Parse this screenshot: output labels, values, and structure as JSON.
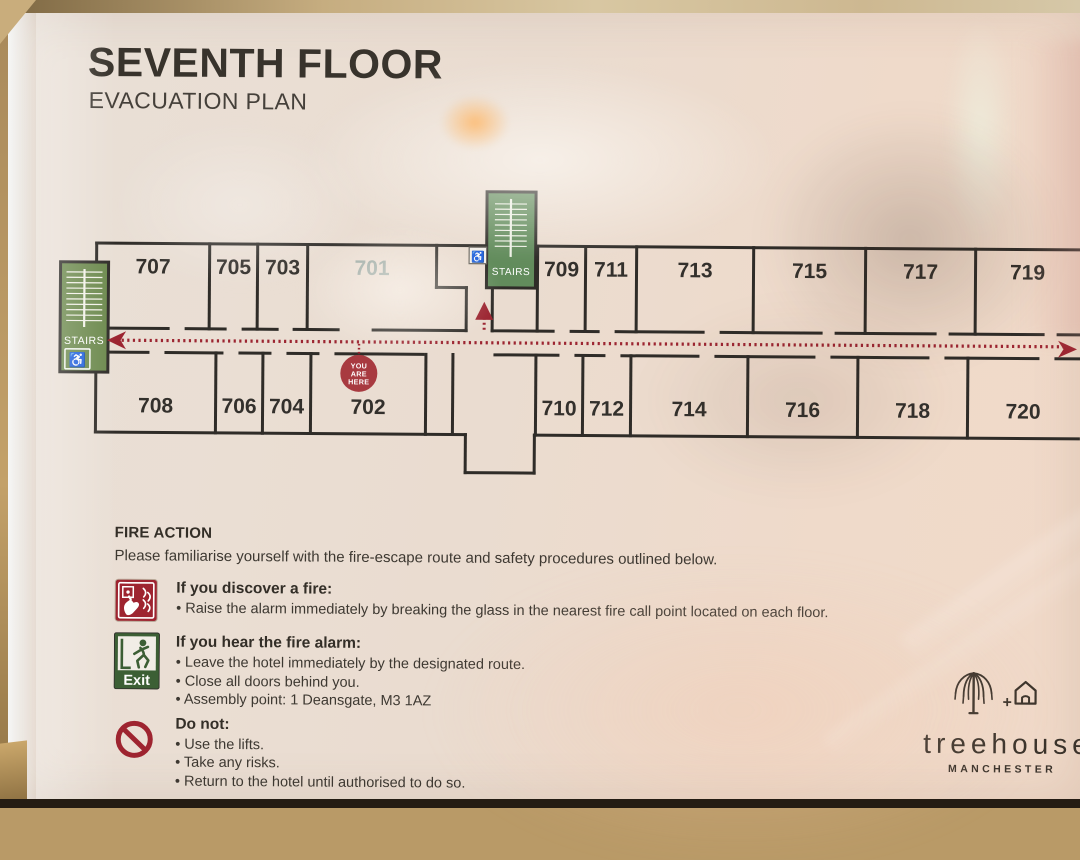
{
  "sign": {
    "title": "SEVENTH FLOOR",
    "subtitle": "EVACUATION PLAN"
  },
  "floor_plan": {
    "rooms_top": [
      "707",
      "705",
      "703",
      "701",
      "709",
      "711",
      "713",
      "715",
      "717",
      "719"
    ],
    "rooms_bottom": [
      "708",
      "706",
      "704",
      "702",
      "710",
      "712",
      "714",
      "716",
      "718",
      "720"
    ],
    "faded_rooms": [
      "701"
    ],
    "stairs_label": "STAIRS",
    "you_are_here_lines": [
      "YOU",
      "ARE",
      "HERE"
    ],
    "icons": [
      "stairs-icon",
      "wheelchair-icon",
      "you-are-here-marker",
      "evacuation-route-arrow"
    ],
    "colors": {
      "wall": "#2f2c28",
      "stairs_green": "#6d8a4e",
      "stairs_green_mid": "#628c5c",
      "route_red": "#9c2531",
      "marker_red": "#a83a40",
      "room_number": "#33302c",
      "faded_room_number": "#9aa8a2"
    }
  },
  "fire_action": {
    "heading": "FIRE ACTION",
    "intro": "Please familiarise yourself with the fire-escape route and safety procedures outlined below.",
    "sections": [
      {
        "icon": "fire-call-point-icon",
        "title": "If you discover a fire:",
        "bullets": [
          "Raise the alarm immediately by breaking the glass in the nearest fire call point located on each floor."
        ]
      },
      {
        "icon": "exit-running-man-icon",
        "icon_label": "Exit",
        "title": "If you hear the fire alarm:",
        "bullets": [
          "Leave the hotel immediately by the designated route.",
          "Close all doors behind you.",
          "Assembly point: 1 Deansgate, M3 1AZ"
        ]
      },
      {
        "icon": "prohibition-icon",
        "title": "Do not:",
        "bullets": [
          "Use the lifts.",
          "Take any risks.",
          "Return to the hotel until authorised to do so."
        ]
      }
    ]
  },
  "brand": {
    "wordmark": "treehouse",
    "city": "MANCHESTER",
    "plus": "+",
    "icons": [
      "tree-icon",
      "house-icon"
    ]
  }
}
